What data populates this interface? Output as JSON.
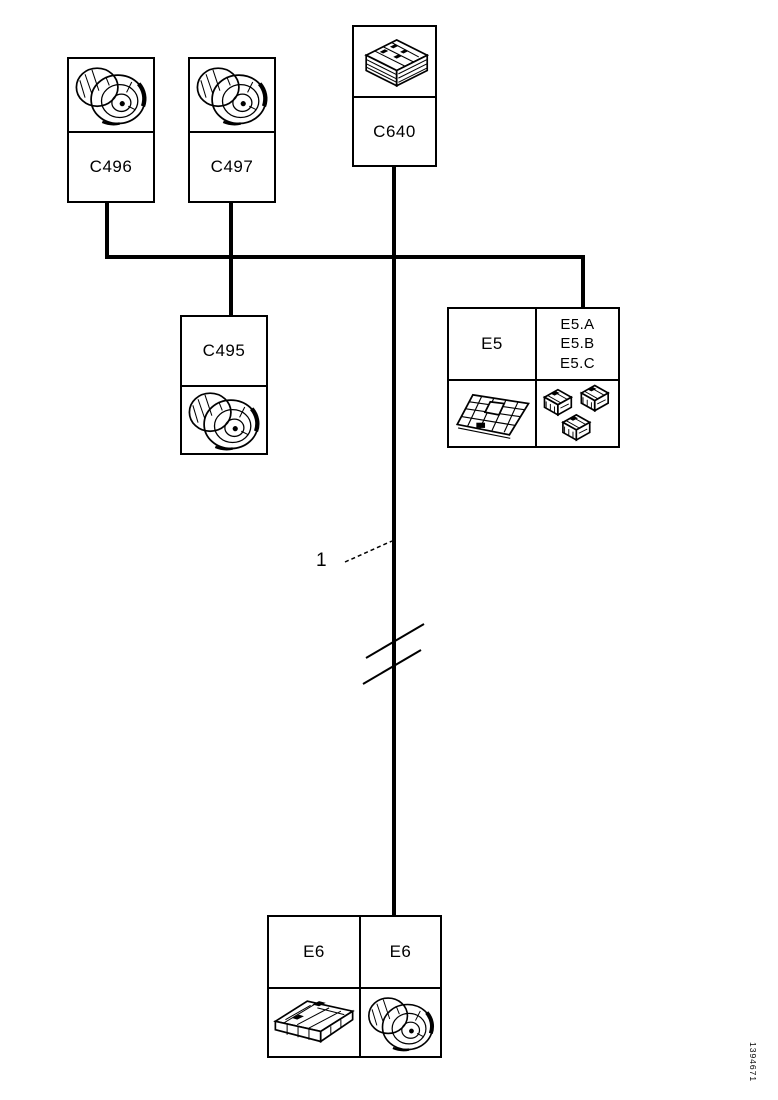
{
  "page": {
    "background": "#ffffff",
    "line_color": "#000000"
  },
  "nodes": {
    "c496": {
      "label": "C496",
      "icon": "round-connector"
    },
    "c497": {
      "label": "C497",
      "icon": "round-connector"
    },
    "c640": {
      "label": "C640",
      "icon": "block-connector"
    },
    "c495": {
      "label": "C495",
      "icon": "round-connector"
    },
    "e5": {
      "label": "E5",
      "variants": [
        "E5.A",
        "E5.B",
        "E5.C"
      ],
      "icons": [
        "module-frame",
        "triple-connector"
      ]
    },
    "e6": {
      "labels": [
        "E6",
        "E6"
      ],
      "icons": [
        "ecu-module",
        "round-connector"
      ]
    }
  },
  "callout": {
    "number": "1"
  },
  "doc_id": "1394671"
}
